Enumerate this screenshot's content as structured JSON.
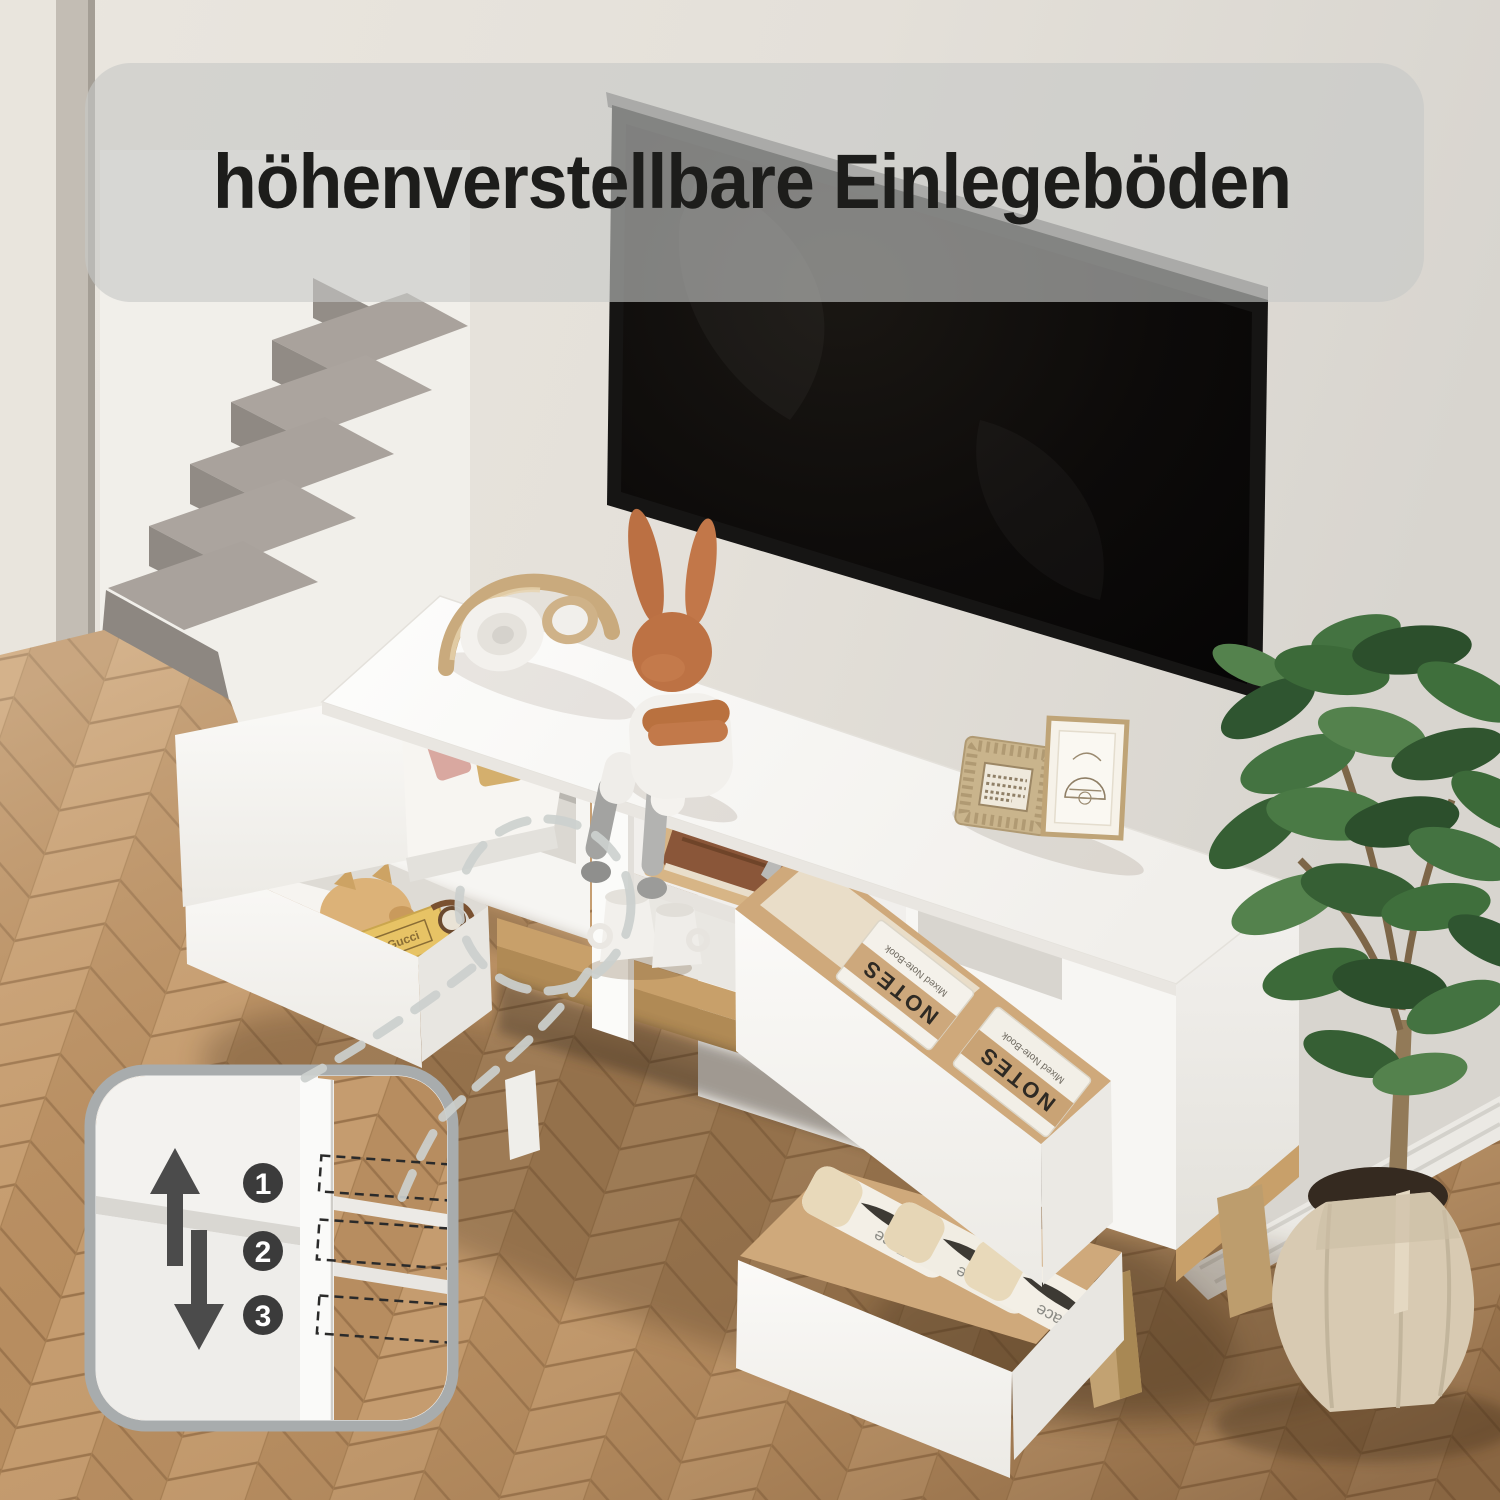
{
  "banner": {
    "text": "höhenverstellbare Einlegeböden"
  },
  "inset": {
    "position_labels": [
      "1",
      "2",
      "3"
    ],
    "icon_names": [
      "arrow-up-icon",
      "arrow-down-icon"
    ]
  },
  "props": {
    "notebook_label": "NOTES",
    "notebook_sublabel": "Mixed Note-Book",
    "tissue_label": "Face",
    "book_label": "Gucci"
  },
  "colors": {
    "banner_bg": "#c6c8c7",
    "banner_text": "#1d1d1b",
    "badge_bg": "#3b3b3b",
    "badge_text": "#ffffff",
    "arrow": "#4b4b4b",
    "wall": "#e8e4dd",
    "wall_right": "#d9d6d0",
    "carpet_tread": "#a9a29c",
    "carpet_riser": "#918b85",
    "floor_light": "#c59c6f",
    "floor_dark": "#b78d60",
    "cabinet_white": "#f8f7f4",
    "wood": "#c8a06a",
    "kraft": "#cfa97b",
    "tv_frame": "#161514",
    "tv_screen": "#0b0a09",
    "plant_green": "#3f6b3d",
    "pot_fabric": "#d8cab2",
    "bunny_orange": "#bb7043",
    "dash_gray": "#ccd0ce"
  }
}
